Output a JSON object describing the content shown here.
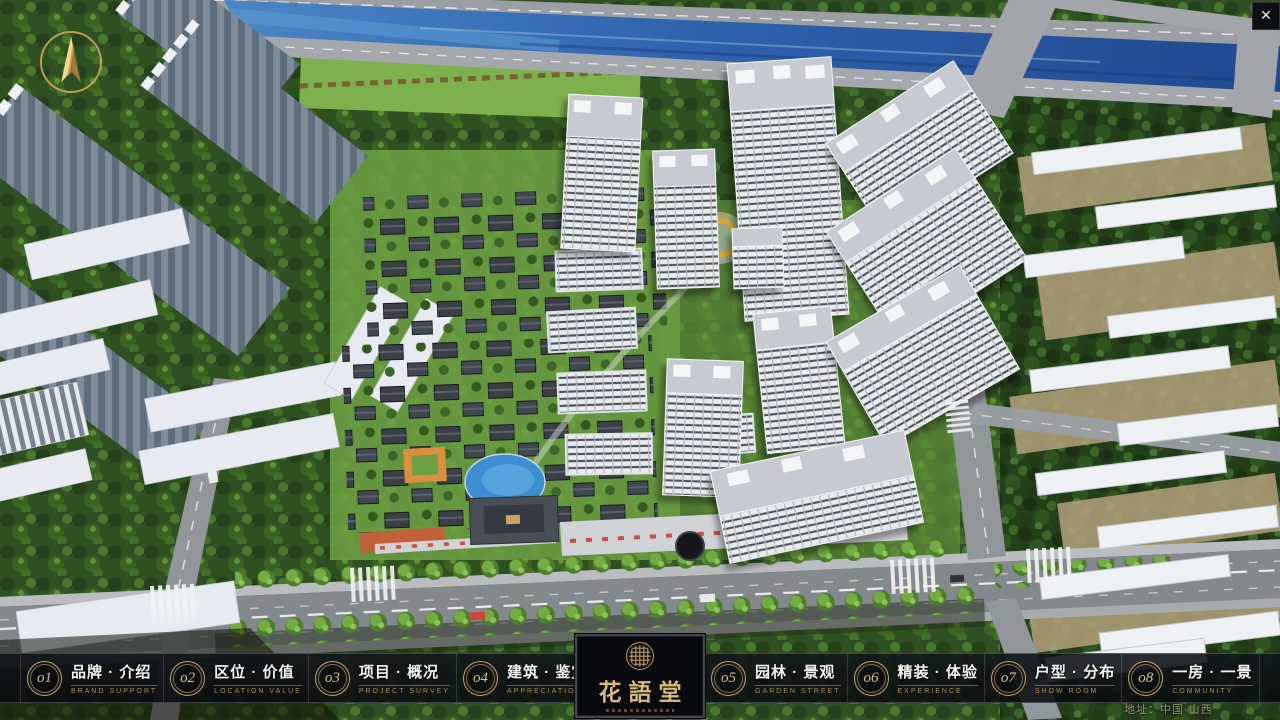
{
  "window": {
    "close_icon": "✕"
  },
  "map": {
    "compass_icon": "compass-north-arrow"
  },
  "footer": {
    "address": "地址：中国·山西",
    "logo": {
      "title": "花語堂",
      "seal_icon": "gold-seal-emblem"
    },
    "menu_left": [
      {
        "num": "o1",
        "title": "品牌 · 介绍",
        "subtitle": "BRAND SUPPORT"
      },
      {
        "num": "o2",
        "title": "区位 · 价值",
        "subtitle": "LOCATION VALUE"
      },
      {
        "num": "o3",
        "title": "项目 · 概况",
        "subtitle": "PROJECT SURVEY"
      },
      {
        "num": "o4",
        "title": "建筑 · 鉴赏",
        "subtitle": "APPRECIATION"
      }
    ],
    "menu_right": [
      {
        "num": "o5",
        "title": "园林 · 景观",
        "subtitle": "GARDEN STREET"
      },
      {
        "num": "o6",
        "title": "精装 · 体验",
        "subtitle": "EXPERIENCE"
      },
      {
        "num": "o7",
        "title": "户型 · 分布",
        "subtitle": "SHOW ROOM"
      },
      {
        "num": "o8",
        "title": "一房 · 一景",
        "subtitle": "COMMUNITY"
      }
    ]
  },
  "colors": {
    "gold_accent": "#c9a363",
    "bar_background": "rgba(12,16,22,0.88)",
    "river_blue": "#2f62ae",
    "grass_green": "#4e7c33",
    "tower_white": "#eef0f2"
  }
}
